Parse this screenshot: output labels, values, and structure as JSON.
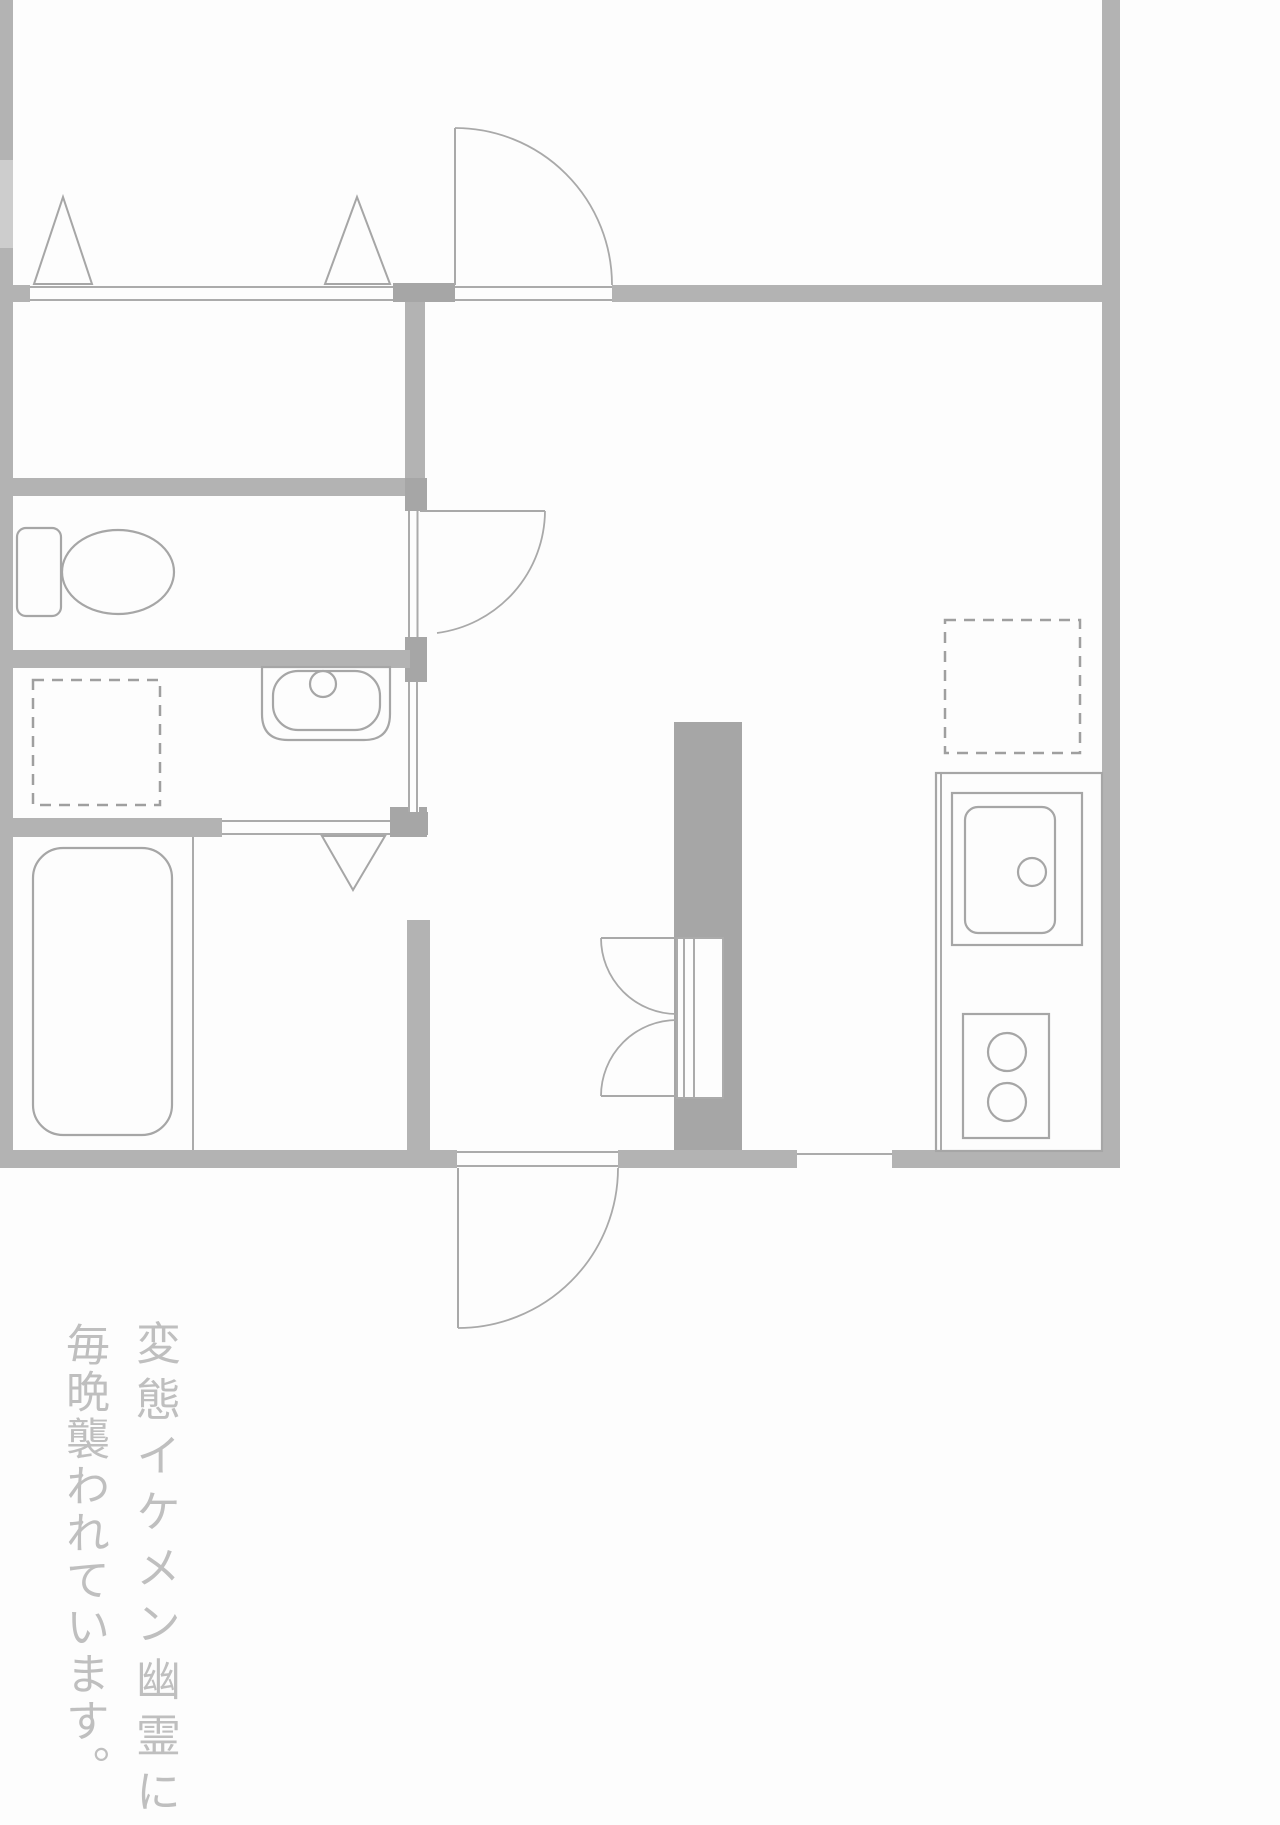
{
  "canvas": {
    "width": 1280,
    "height": 1825,
    "background": "#fdfdfd"
  },
  "palette": {
    "wall": "#b3b3b3",
    "wall_dark": "#a6a6a6",
    "wall_light": "#cdcdcd",
    "thin_line": "#ababab",
    "door_line": "#a9a9a9",
    "fixture_line": "#a6a6a6",
    "dash_line": "#9f9f9f",
    "white": "#fdfdfd",
    "caption_text": "#bfbfbf"
  },
  "caption": {
    "line1": "変態イケメン幽霊に",
    "line2": "毎晩襲われています。"
  },
  "floorplan": {
    "walls": [
      {
        "name": "left-wall-upper",
        "x": 0,
        "y": 0,
        "w": 13,
        "h": 160,
        "f": "wall"
      },
      {
        "name": "left-wall-window",
        "x": 0,
        "y": 160,
        "w": 13,
        "h": 88,
        "f": "wall_light"
      },
      {
        "name": "left-wall-lower",
        "x": 0,
        "y": 248,
        "w": 13,
        "h": 920,
        "f": "wall"
      },
      {
        "name": "right-wall",
        "x": 1102,
        "y": 0,
        "w": 18,
        "h": 1168,
        "f": "wall"
      },
      {
        "name": "top-wall-left-stub",
        "x": 0,
        "y": 285,
        "w": 30,
        "h": 17,
        "f": "wall"
      },
      {
        "name": "top-wall-mid-block",
        "x": 393,
        "y": 283,
        "w": 62,
        "h": 19,
        "f": "wall_dark"
      },
      {
        "name": "top-wall-right",
        "x": 612,
        "y": 285,
        "w": 490,
        "h": 17,
        "f": "wall"
      },
      {
        "name": "closet-right-wall",
        "x": 405,
        "y": 302,
        "w": 20,
        "h": 177,
        "f": "wall"
      },
      {
        "name": "toilet-top-wall",
        "x": 0,
        "y": 478,
        "w": 427,
        "h": 18,
        "f": "wall"
      },
      {
        "name": "toilet-door-top-block",
        "x": 405,
        "y": 478,
        "w": 22,
        "h": 33,
        "f": "wall_dark"
      },
      {
        "name": "toilet-door-bottom-block",
        "x": 405,
        "y": 637,
        "w": 22,
        "h": 45,
        "f": "wall_dark"
      },
      {
        "name": "washroom-door-bottom-block",
        "x": 404,
        "y": 812,
        "w": 24,
        "h": 23,
        "f": "wall_dark"
      },
      {
        "name": "hall-left-wall",
        "x": 407,
        "y": 920,
        "w": 23,
        "h": 230,
        "f": "wall"
      },
      {
        "name": "toilet-bottom-wall",
        "x": 0,
        "y": 650,
        "w": 410,
        "h": 18,
        "f": "wall"
      },
      {
        "name": "bath-top-wall",
        "x": 0,
        "y": 818,
        "w": 222,
        "h": 19,
        "f": "wall"
      },
      {
        "name": "bath-door-right-block",
        "x": 390,
        "y": 807,
        "w": 37,
        "h": 30,
        "f": "wall_dark"
      },
      {
        "name": "kitchen-partition-column",
        "x": 674,
        "y": 722,
        "w": 68,
        "h": 428,
        "f": "wall_dark"
      },
      {
        "name": "bottom-wall-left",
        "x": 0,
        "y": 1150,
        "w": 457,
        "h": 18,
        "f": "wall"
      },
      {
        "name": "bottom-wall-mid",
        "x": 618,
        "y": 1150,
        "w": 179,
        "h": 18,
        "f": "wall"
      },
      {
        "name": "bottom-wall-right",
        "x": 892,
        "y": 1150,
        "w": 228,
        "h": 18,
        "f": "wall"
      }
    ],
    "openings": [
      {
        "name": "top-window-band",
        "x": 30,
        "y": 286,
        "w": 363,
        "h": 15
      },
      {
        "name": "top-door-sill",
        "x": 455,
        "y": 286,
        "w": 157,
        "h": 15
      },
      {
        "name": "toilet-door-jamb",
        "x": 408,
        "y": 511,
        "w": 11,
        "h": 126
      },
      {
        "name": "washroom-sliding-door",
        "x": 408,
        "y": 682,
        "w": 11,
        "h": 130
      },
      {
        "name": "bath-folding-door-band",
        "x": 222,
        "y": 820,
        "w": 168,
        "h": 15
      },
      {
        "name": "double-door-recess",
        "x": 677,
        "y": 938,
        "w": 46,
        "h": 160,
        "border": true
      },
      {
        "name": "entrance-door-sill",
        "x": 457,
        "y": 1150,
        "w": 161,
        "h": 18
      },
      {
        "name": "kitchen-pass-opening",
        "x": 797,
        "y": 1150,
        "w": 95,
        "h": 18
      }
    ],
    "thin_lines": [
      {
        "name": "window-line-outer",
        "x1": 30,
        "y1": 287,
        "x2": 393,
        "y2": 287
      },
      {
        "name": "window-line-inner",
        "x1": 30,
        "y1": 300,
        "x2": 393,
        "y2": 300
      },
      {
        "name": "top-door-sill-outer",
        "x1": 455,
        "y1": 287,
        "x2": 612,
        "y2": 287
      },
      {
        "name": "top-door-sill-inner",
        "x1": 455,
        "y1": 300,
        "x2": 612,
        "y2": 300
      },
      {
        "name": "toilet-jamb-left",
        "x1": 409,
        "y1": 511,
        "x2": 409,
        "y2": 637
      },
      {
        "name": "toilet-jamb-right",
        "x1": 417.5,
        "y1": 511,
        "x2": 417.5,
        "y2": 637
      },
      {
        "name": "washroom-slide-left",
        "x1": 409,
        "y1": 682,
        "x2": 409,
        "y2": 812
      },
      {
        "name": "washroom-slide-right",
        "x1": 417,
        "y1": 682,
        "x2": 417,
        "y2": 812
      },
      {
        "name": "bath-door-line-top",
        "x1": 222,
        "y1": 821,
        "x2": 390,
        "y2": 821
      },
      {
        "name": "bath-door-line-bottom",
        "x1": 222,
        "y1": 834,
        "x2": 390,
        "y2": 834
      },
      {
        "name": "double-door-frame-1",
        "x1": 684,
        "y1": 938,
        "x2": 684,
        "y2": 1098
      },
      {
        "name": "double-door-frame-2",
        "x1": 694,
        "y1": 938,
        "x2": 694,
        "y2": 1098
      },
      {
        "name": "entrance-sill-outer",
        "x1": 457,
        "y1": 1152,
        "x2": 618,
        "y2": 1152
      },
      {
        "name": "entrance-sill-inner",
        "x1": 457,
        "y1": 1166,
        "x2": 618,
        "y2": 1166
      },
      {
        "name": "kitchen-pass-line",
        "x1": 797,
        "y1": 1154,
        "x2": 892,
        "y2": 1154
      },
      {
        "name": "bath-partition-line",
        "x1": 193,
        "y1": 837,
        "x2": 193,
        "y2": 1150
      },
      {
        "name": "counter-left-inner-edge",
        "x1": 941,
        "y1": 773,
        "x2": 941,
        "y2": 1151
      }
    ],
    "doors": [
      {
        "name": "bedroom-door",
        "leaf": {
          "x1": 455,
          "y1": 285,
          "x2": 455,
          "y2": 128
        },
        "arc": "M 455 128 A 157 157 0 0 1 612 285"
      },
      {
        "name": "toilet-door",
        "leaf": {
          "x1": 420,
          "y1": 511,
          "x2": 545,
          "y2": 511
        },
        "arc": "M 545 511 A 124 124 0 0 1 437 633"
      },
      {
        "name": "double-door-top-leaf",
        "leaf": {
          "x1": 601,
          "y1": 938,
          "x2": 677,
          "y2": 938
        },
        "arc": "M 601 938 A 76 76 0 0 0 677 1014"
      },
      {
        "name": "double-door-bottom-leaf",
        "leaf": {
          "x1": 601,
          "y1": 1096,
          "x2": 677,
          "y2": 1096
        },
        "arc": "M 601 1096 A 76 76 0 0 1 677 1020"
      },
      {
        "name": "entrance-door",
        "leaf": {
          "x1": 458,
          "y1": 1168,
          "x2": 458,
          "y2": 1328
        },
        "arc": "M 618 1168 A 160 160 0 0 1 458 1328"
      }
    ],
    "triangles": [
      {
        "name": "window-marker-left",
        "points": "34,284 92,284 63,197"
      },
      {
        "name": "window-marker-right",
        "points": "325,284 390,284 357,197"
      },
      {
        "name": "bath-door-marker",
        "points": "322,836 385,836 353,890"
      }
    ],
    "dashed_rects": [
      {
        "name": "washer-space",
        "x": 33,
        "y": 680,
        "w": 127,
        "h": 125
      },
      {
        "name": "refrigerator-space",
        "x": 945,
        "y": 620,
        "w": 135,
        "h": 133
      }
    ],
    "fixtures": [
      {
        "name": "toilet-bowl",
        "t": "ellipse",
        "cx": 118,
        "cy": 572,
        "rx": 56,
        "ry": 42
      },
      {
        "name": "toilet-tank",
        "t": "rrect",
        "x": 17,
        "y": 528,
        "w": 44,
        "h": 88,
        "r": 9,
        "fillWhite": true
      },
      {
        "name": "washbasin-counter",
        "t": "path",
        "d": "M 262 667 L 390 667 L 390 714 Q 390 740 364 740 L 288 740 Q 262 740 262 714 Z"
      },
      {
        "name": "washbasin-basin",
        "t": "rrect",
        "x": 273,
        "y": 671,
        "w": 107,
        "h": 59,
        "r": 25
      },
      {
        "name": "washbasin-faucet",
        "t": "circle",
        "cx": 323,
        "cy": 684,
        "r": 13,
        "fillWhite": true
      },
      {
        "name": "bathtub",
        "t": "rrect",
        "x": 33,
        "y": 848,
        "w": 139,
        "h": 287,
        "r": 30
      },
      {
        "name": "kitchen-counter",
        "t": "rect",
        "x": 936,
        "y": 773,
        "w": 166,
        "h": 378
      },
      {
        "name": "kitchen-sink-surround",
        "t": "rect",
        "x": 952,
        "y": 793,
        "w": 130,
        "h": 152
      },
      {
        "name": "kitchen-sink",
        "t": "rrect",
        "x": 965,
        "y": 807,
        "w": 90,
        "h": 126,
        "r": 13
      },
      {
        "name": "kitchen-faucet",
        "t": "circle",
        "cx": 1032,
        "cy": 872,
        "r": 14,
        "fillWhite": true
      },
      {
        "name": "stove",
        "t": "rect",
        "x": 963,
        "y": 1014,
        "w": 86,
        "h": 124
      },
      {
        "name": "stove-burner-1",
        "t": "circle",
        "cx": 1007,
        "cy": 1052,
        "r": 19
      },
      {
        "name": "stove-burner-2",
        "t": "circle",
        "cx": 1007,
        "cy": 1102,
        "r": 19
      }
    ]
  }
}
